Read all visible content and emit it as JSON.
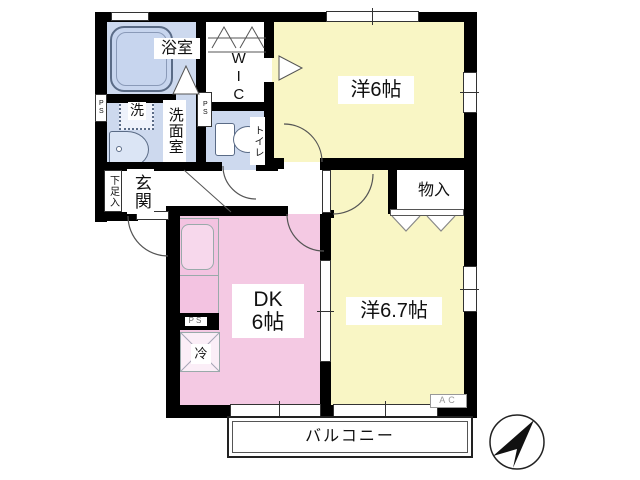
{
  "colors": {
    "wall": "#000000",
    "wet_room": "#cdd9ee",
    "room_yellow": "#f9f6c5",
    "room_pink": "#f4c9e3"
  },
  "rooms": {
    "bath": {
      "label": "浴室"
    },
    "washroom": {
      "label": "洗面室"
    },
    "washer": {
      "label": "洗"
    },
    "wic": {
      "label": "WIC"
    },
    "toilet": {
      "label": "トイレ"
    },
    "western6": {
      "label": "洋6帖"
    },
    "entrance": {
      "label": "玄関"
    },
    "shoe_cabinet": {
      "label": "下足入"
    },
    "storage": {
      "label": "物入"
    },
    "dk": {
      "label_top": "DK",
      "label_bottom": "6帖"
    },
    "fridge": {
      "label": "冷"
    },
    "western67": {
      "label": "洋6.7帖"
    },
    "balcony": {
      "label": "バルコニー"
    }
  },
  "equipment_labels": {
    "ps": "PS",
    "ac": "AC"
  }
}
